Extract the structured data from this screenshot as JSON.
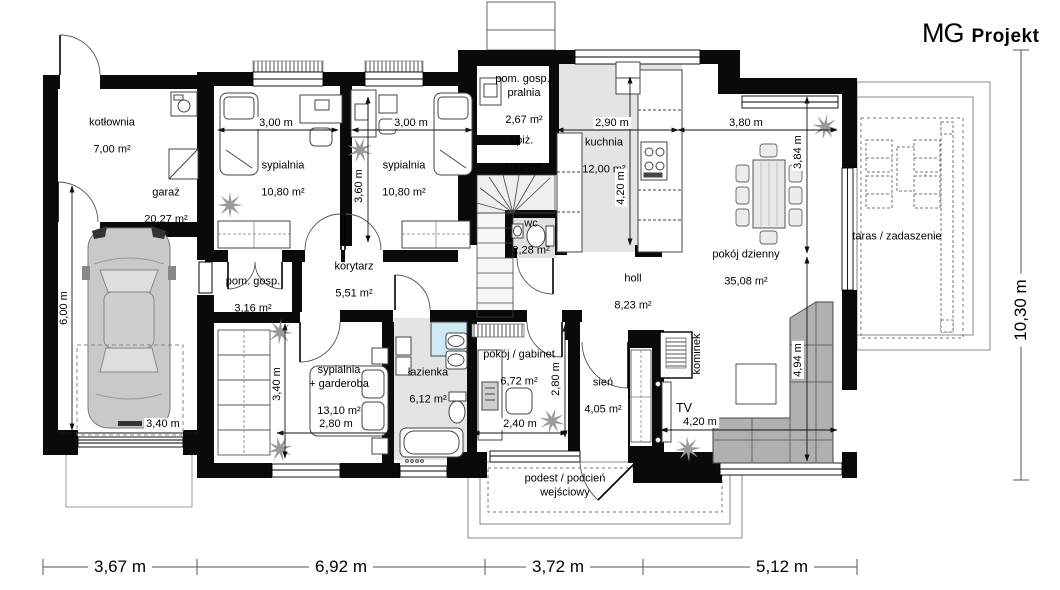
{
  "logo": {
    "mg": "MG",
    "projekt": "Projekt"
  },
  "rooms": {
    "kotlownia": {
      "name": "kotłownia",
      "area": "7,00 m²"
    },
    "garaz": {
      "name": "garaż",
      "area": "20,27 m²"
    },
    "sypialnia1": {
      "name": "sypialnia",
      "area": "10,80 m²"
    },
    "sypialnia2": {
      "name": "sypialnia",
      "area": "10,80 m²"
    },
    "pralnia": {
      "name": "pom. gosp./\npralnia",
      "area": "2,67 m²"
    },
    "spizarnia": {
      "name": "spiż.",
      "area": "1,17 m²"
    },
    "kuchnia": {
      "name": "kuchnia",
      "area": "12,00 m²"
    },
    "wc": {
      "name": "wc",
      "area": "2,28 m²"
    },
    "korytarz": {
      "name": "korytarz",
      "area": "5,51 m²"
    },
    "pom_gosp": {
      "name": "pom. gosp.",
      "area": "3,16 m²"
    },
    "holl": {
      "name": "holl",
      "area": "8,23 m²"
    },
    "pokoj_dzienny": {
      "name": "pokój dzienny",
      "area": "35,08 m²"
    },
    "sypialnia_garderoba": {
      "name": "sypialnia\n+ garderoba",
      "area": "13,10 m²"
    },
    "lazienka": {
      "name": "łazienka",
      "area": "6,12 m²"
    },
    "gabinet": {
      "name": "pokój / gabinet",
      "area": "6,72 m²"
    },
    "sien": {
      "name": "sień",
      "area": "4,05 m²"
    },
    "taras": {
      "name": "taras / zadaszenie"
    },
    "podest": {
      "name": "podest / podcień\nwejściowy"
    },
    "kominek": {
      "name": "kominek"
    },
    "tv": {
      "name": "TV"
    }
  },
  "dimensions": {
    "syp1_w": "3,00 m",
    "syp2_w": "3,00 m",
    "kuchnia_w": "2,90 m",
    "salon_w": "3,80 m",
    "syp_h": "3,60 m",
    "kuchnia_h": "4,20 m",
    "salon_h1": "3,84 m",
    "salon_h2": "4,94 m",
    "garaz_h": "6,00 m",
    "garaz_w": "3,40 m",
    "garderoba_h": "3,40 m",
    "bed_w": "2,80 m",
    "gabinet_w": "2,40 m",
    "gabinet_h": "2,80 m",
    "tv_w": "4,20 m",
    "total_h": "10,30 m",
    "bottom_1": "3,67 m",
    "bottom_2": "6,92 m",
    "bottom_3": "3,72 m",
    "bottom_4": "5,12 m"
  }
}
